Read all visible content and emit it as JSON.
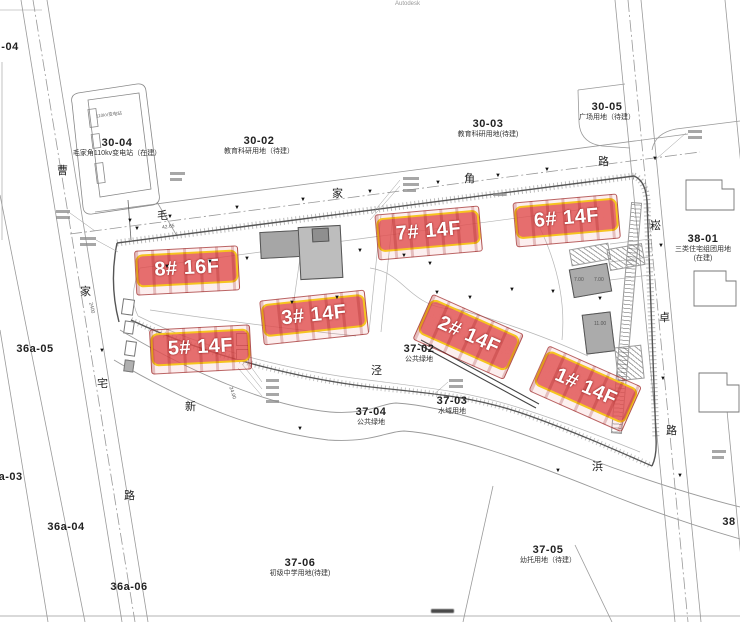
{
  "watermarks": {
    "top": "Autodesk"
  },
  "parcels": [
    {
      "code": "-04"
    },
    {
      "code": "30-04",
      "use": "毛家角110kv变电站（在建）"
    },
    {
      "code": "30-02",
      "use": "教育科研用地（待建）"
    },
    {
      "code": "30-03",
      "use": "教育科研用地(待建)"
    },
    {
      "code": "30-05",
      "use": "广场用地（待建）"
    },
    {
      "code": "38-01",
      "use": "三类住宅组团用地",
      "use2": "(在建)"
    },
    {
      "code": "36a-05"
    },
    {
      "code": "36a-03"
    },
    {
      "code": "36a-04"
    },
    {
      "code": "36a-06"
    },
    {
      "code": "37-02",
      "use": "公共绿地"
    },
    {
      "code": "37-03",
      "use": "水域用地"
    },
    {
      "code": "37-04",
      "use": "公共绿地"
    },
    {
      "code": "37-06",
      "use": "初级中学用地(待建)"
    },
    {
      "code": "37-05",
      "use": "幼托用地（待建）"
    },
    {
      "code": "38"
    }
  ],
  "roads": [
    {
      "name": "曹家宅路",
      "chars": [
        "曹",
        "家",
        "宅",
        "路"
      ]
    },
    {
      "name": "毛家角路",
      "chars": [
        "毛",
        "家",
        "角",
        "路"
      ]
    },
    {
      "name": "崧卓路",
      "chars": [
        "崧",
        "卓",
        "路"
      ]
    },
    {
      "name": "新泾浜",
      "chars": [
        "新",
        "泾",
        "浜"
      ]
    }
  ],
  "buildings": [
    {
      "label": "8# 16F"
    },
    {
      "label": "7# 14F"
    },
    {
      "label": "6# 14F"
    },
    {
      "label": "5# 14F"
    },
    {
      "label": "3# 14F"
    },
    {
      "label": "2# 14F"
    },
    {
      "label": "1# 14F"
    }
  ],
  "dimensions": [
    "2400",
    "24.00",
    "42.65",
    "7.00",
    "7.00",
    "11.00"
  ],
  "tiny_labels": [
    "110kV变电站"
  ],
  "colors": {
    "highlight_fill": "#de4848",
    "highlight_border": "#f7ce14",
    "highlight_text": "#ffffff",
    "existing_building": "#b0b0b0",
    "fence": "#555555",
    "line": "#9a9a9a"
  },
  "map_symbols": {
    "survey_marker": "▼",
    "survey_marker_positions": [
      [
        130,
        222
      ],
      [
        170,
        218
      ],
      [
        237,
        209
      ],
      [
        303,
        201
      ],
      [
        370,
        193
      ],
      [
        438,
        184
      ],
      [
        498,
        177
      ],
      [
        547,
        171
      ],
      [
        655,
        160
      ],
      [
        661,
        247
      ],
      [
        663,
        380
      ],
      [
        680,
        477
      ],
      [
        137,
        230
      ],
      [
        102,
        352
      ],
      [
        167,
        268
      ],
      [
        210,
        263
      ],
      [
        247,
        260
      ],
      [
        292,
        304
      ],
      [
        337,
        299
      ],
      [
        360,
        252
      ],
      [
        404,
        257
      ],
      [
        430,
        265
      ],
      [
        437,
        294
      ],
      [
        470,
        299
      ],
      [
        512,
        291
      ],
      [
        553,
        293
      ],
      [
        600,
        300
      ],
      [
        558,
        472
      ],
      [
        300,
        430
      ]
    ]
  }
}
